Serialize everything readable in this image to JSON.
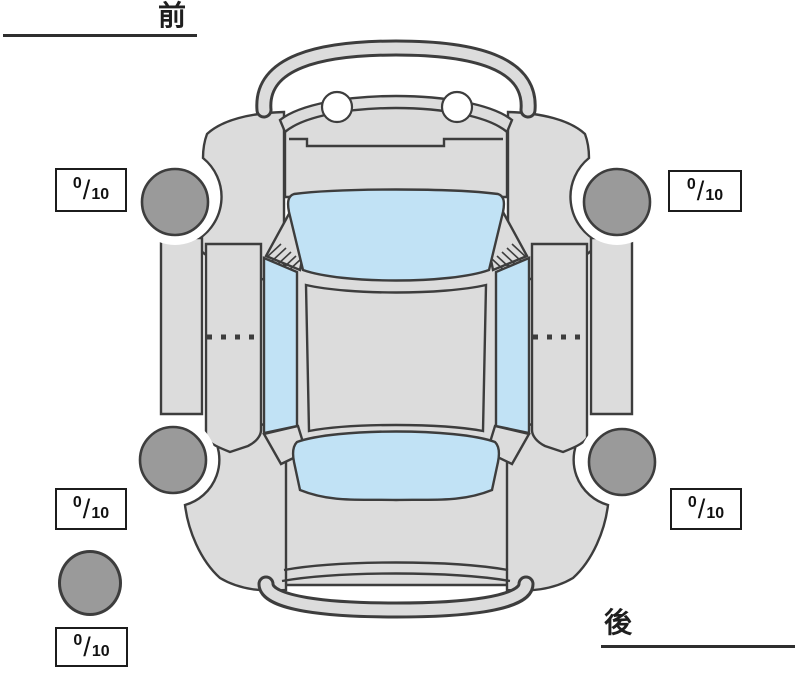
{
  "orientation": {
    "front": "前",
    "rear": "後"
  },
  "tread_scores": {
    "front_left": {
      "value": "0",
      "separator": "/",
      "max": "10"
    },
    "front_right": {
      "value": "0",
      "separator": "/",
      "max": "10"
    },
    "rear_left": {
      "value": "0",
      "separator": "/",
      "max": "10"
    },
    "rear_right": {
      "value": "0",
      "separator": "/",
      "max": "10"
    },
    "spare": {
      "value": "0",
      "separator": "/",
      "max": "10"
    }
  },
  "colors": {
    "car_body": "#dcdcdc",
    "glass": "#c1e2f5",
    "tire": "#9a9a9a",
    "outline": "#3d3d3d"
  }
}
